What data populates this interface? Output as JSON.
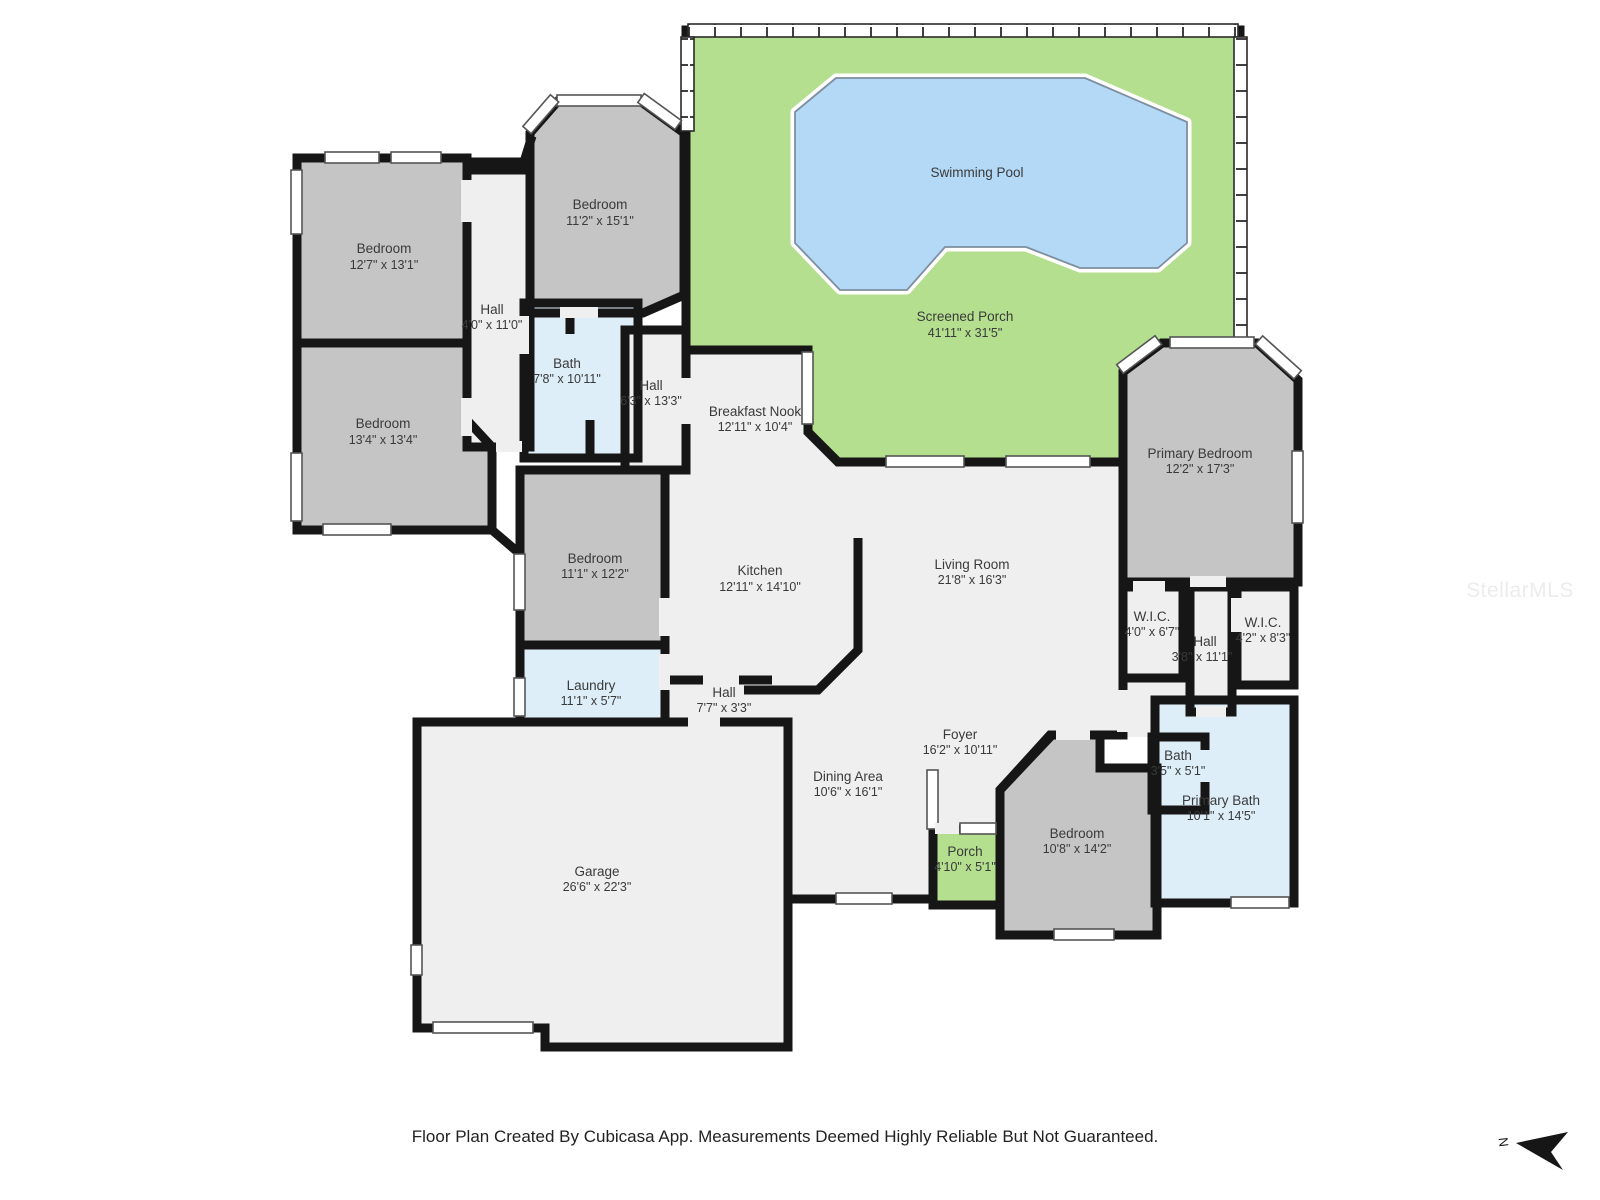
{
  "footer": {
    "text": "Floor Plan Created By Cubicasa App. Measurements Deemed Highly Reliable But Not Guaranteed."
  },
  "watermark": "StellarMLS",
  "compass": {
    "label": "N"
  },
  "colors": {
    "wall": "#161616",
    "bedroom_fill": "#c5c5c5",
    "wet_room_fill": "#ddeef9",
    "porch_fill": "#b4df8e",
    "pool_fill": "#b3d9f7",
    "open_area_fill": "#efefef",
    "label_text": "#3a3a3a"
  },
  "rooms": [
    {
      "id": "screened-porch",
      "name": "Screened Porch",
      "dims": "41'11\" x 31'5\""
    },
    {
      "id": "swimming-pool",
      "name": "Swimming Pool",
      "dims": ""
    },
    {
      "id": "bedroom-top",
      "name": "Bedroom",
      "dims": "11'2\" x 15'1\""
    },
    {
      "id": "bedroom-left-upper",
      "name": "Bedroom",
      "dims": "12'7\" x 13'1\""
    },
    {
      "id": "bedroom-left-lower",
      "name": "Bedroom",
      "dims": "13'4\" x 13'4\""
    },
    {
      "id": "hall-left",
      "name": "Hall",
      "dims": "4'0\" x 11'0\""
    },
    {
      "id": "bath-left",
      "name": "Bath",
      "dims": "7'8\" x 10'11\""
    },
    {
      "id": "hall-center",
      "name": "Hall",
      "dims": "6'3\" x 13'3\""
    },
    {
      "id": "breakfast-nook",
      "name": "Breakfast Nook",
      "dims": "12'11\" x 10'4\""
    },
    {
      "id": "bedroom-middle",
      "name": "Bedroom",
      "dims": "11'1\" x 12'2\""
    },
    {
      "id": "laundry",
      "name": "Laundry",
      "dims": "11'1\" x 5'7\""
    },
    {
      "id": "kitchen",
      "name": "Kitchen",
      "dims": "12'11\" x 14'10\""
    },
    {
      "id": "living-room",
      "name": "Living Room",
      "dims": "21'8\" x 16'3\""
    },
    {
      "id": "hall-small",
      "name": "Hall",
      "dims": "7'7\" x 3'3\""
    },
    {
      "id": "dining-area",
      "name": "Dining Area",
      "dims": "10'6\" x 16'1\""
    },
    {
      "id": "foyer",
      "name": "Foyer",
      "dims": "16'2\" x 10'11\""
    },
    {
      "id": "garage",
      "name": "Garage",
      "dims": "26'6\" x 22'3\""
    },
    {
      "id": "primary-bedroom",
      "name": "Primary Bedroom",
      "dims": "12'2\" x 17'3\""
    },
    {
      "id": "wic-left",
      "name": "W.I.C.",
      "dims": "4'0\" x 6'7\""
    },
    {
      "id": "hall-primary",
      "name": "Hall",
      "dims": "3'8\" x 11'1\""
    },
    {
      "id": "wic-right",
      "name": "W.I.C.",
      "dims": "4'2\" x 8'3\""
    },
    {
      "id": "bath-small",
      "name": "Bath",
      "dims": "3'5\" x 5'1\""
    },
    {
      "id": "primary-bath",
      "name": "Primary Bath",
      "dims": "10'1\" x 14'5\""
    },
    {
      "id": "bedroom-right",
      "name": "Bedroom",
      "dims": "10'8\" x 14'2\""
    },
    {
      "id": "front-porch",
      "name": "Porch",
      "dims": "4'10\" x 5'1\""
    }
  ]
}
